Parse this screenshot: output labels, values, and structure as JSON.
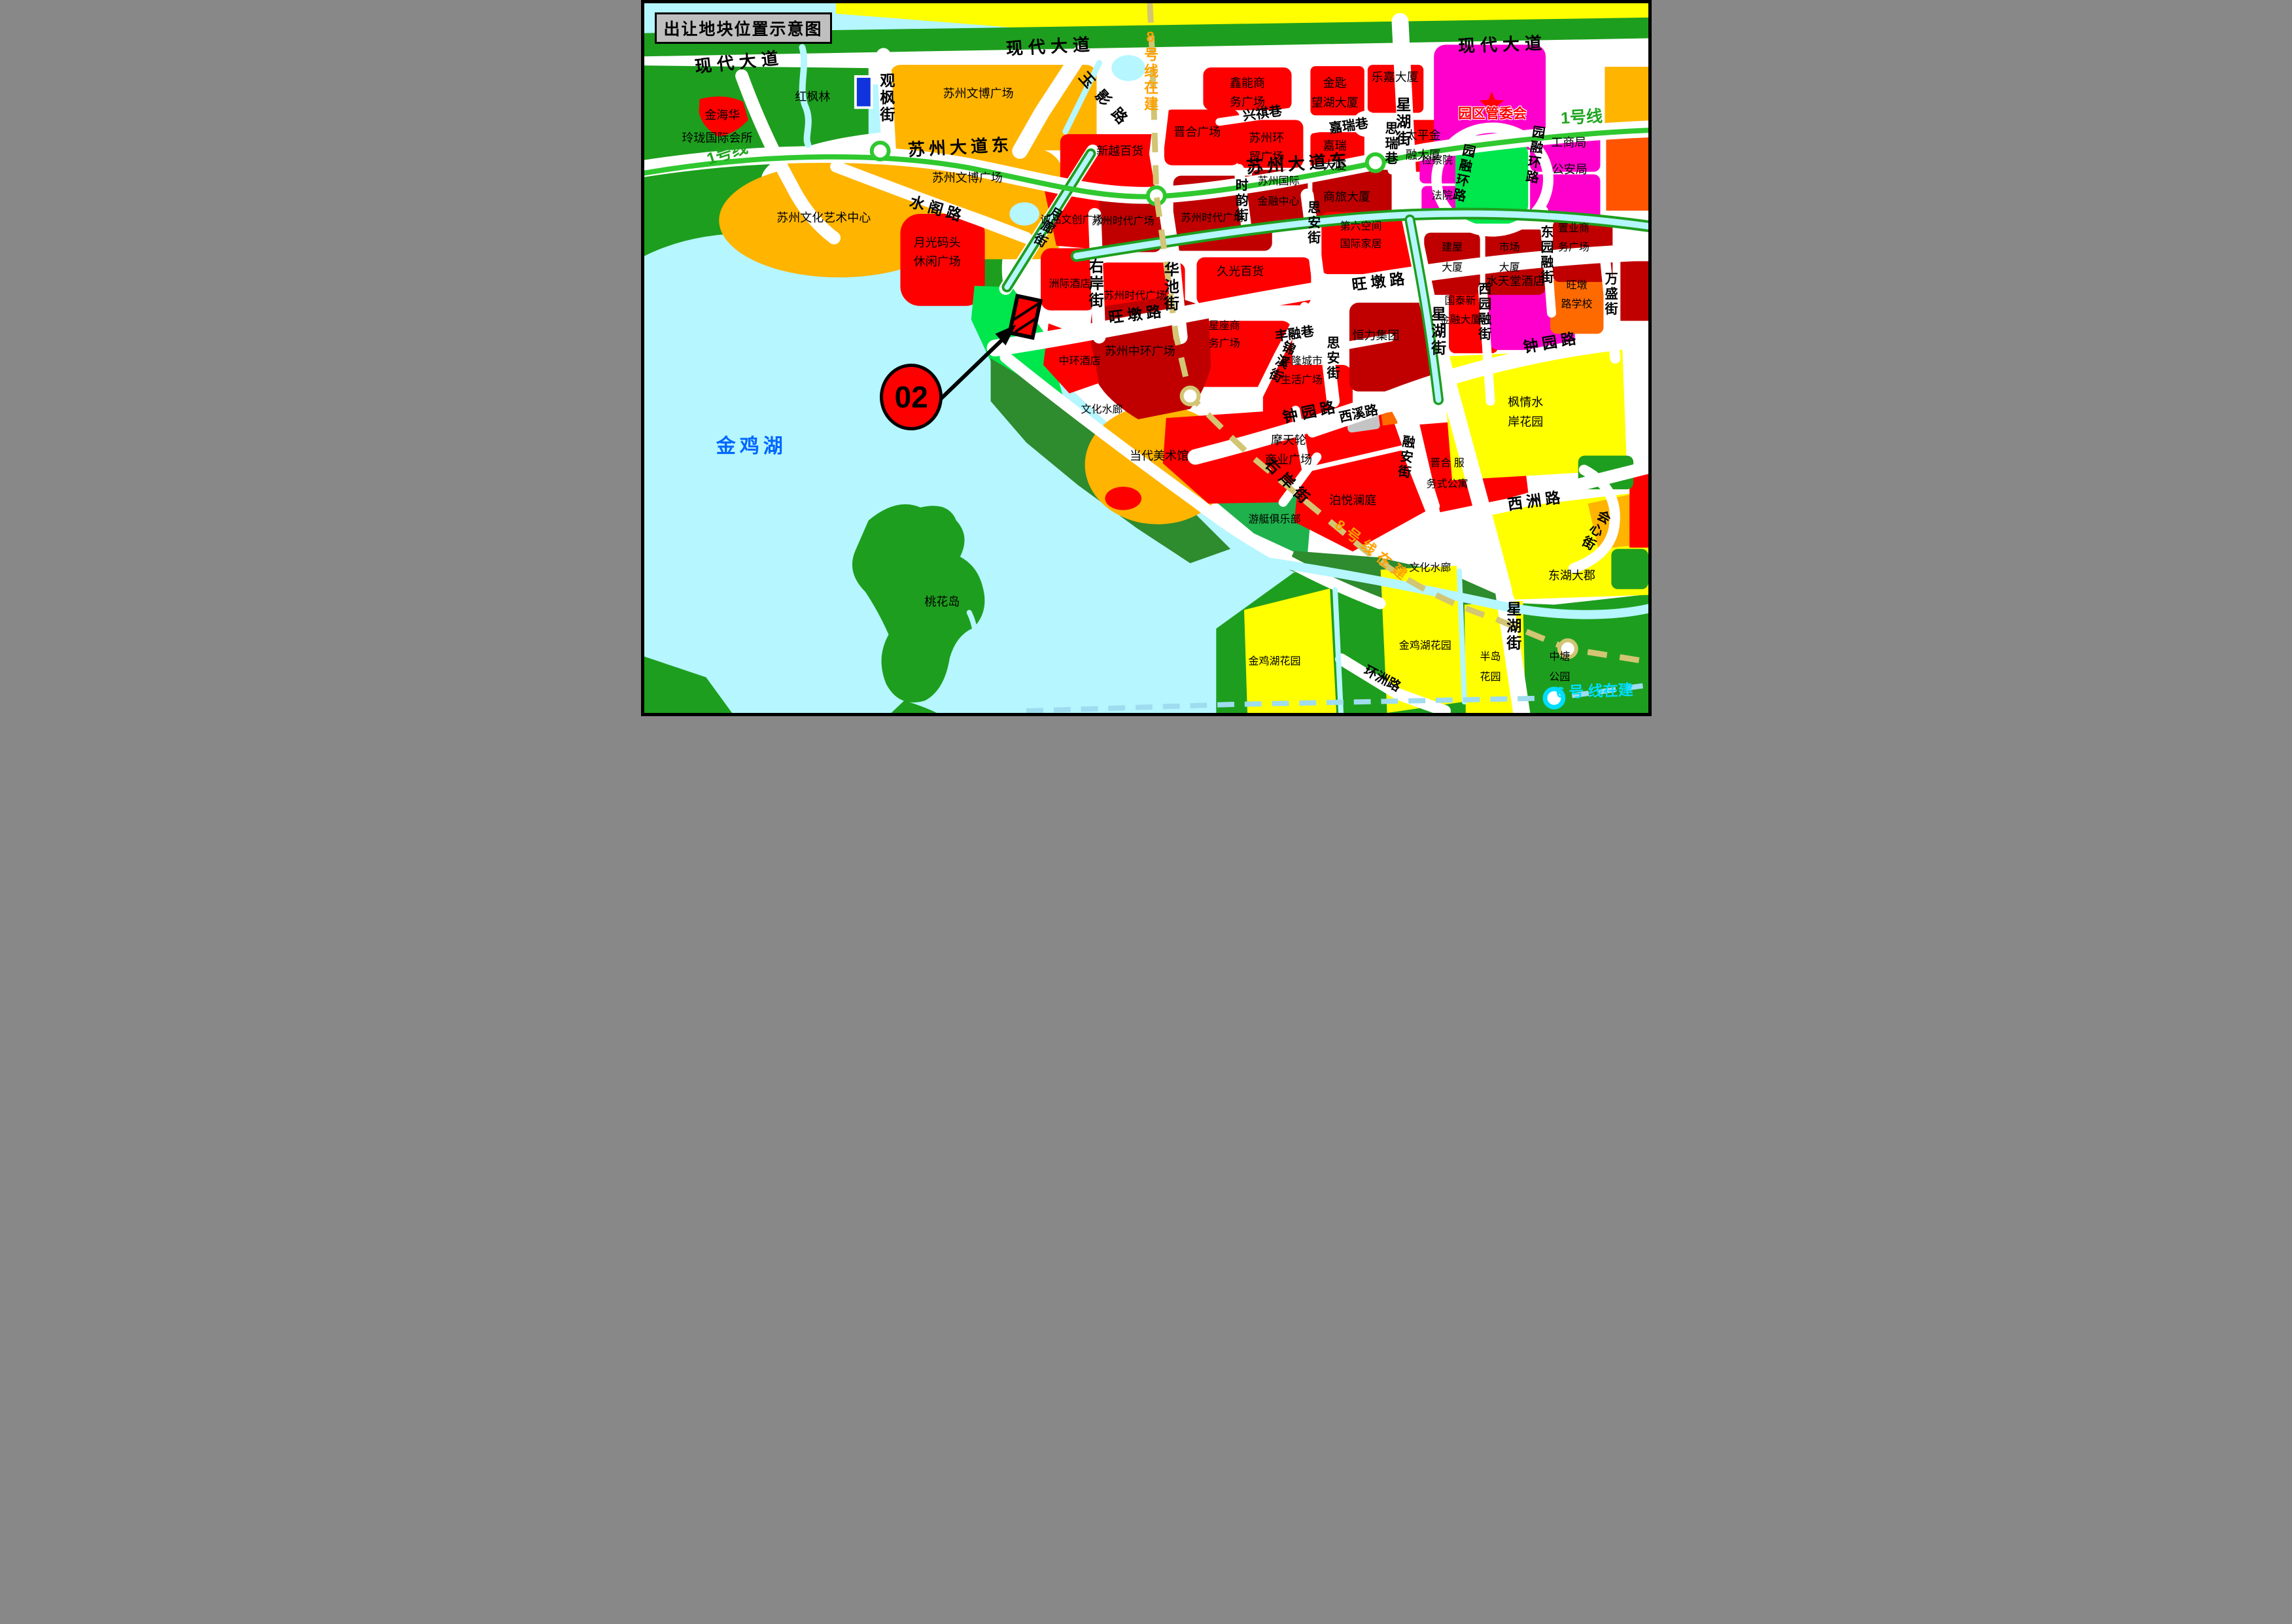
{
  "title": "出让地块位置示意图",
  "marker": {
    "label": "02"
  },
  "palette": {
    "water": "#B5F6FF",
    "green": "#1E9E1E",
    "dkgreen": "#2E8B2E",
    "brgreen": "#00E64D",
    "mdgreen": "#1FB14C",
    "yellow": "#FFFF00",
    "orange": "#FFB400",
    "dporange": "#FF6A00",
    "orangered": "#FF5500",
    "red": "#FF0000",
    "dkred": "#C00000",
    "magenta": "#FF00CC",
    "gray": "#C4C4C4",
    "blue": "#1133DD",
    "road": "#FFFFFF",
    "metro1": "#2FC82F",
    "metro1text": "#1FA51F",
    "metro8": "#D2C573",
    "metro8text": "#FFA000",
    "metro6": "#9FDCEF",
    "metro6text": "#00DDFF",
    "laketext": "#0066FF"
  },
  "labels": [
    {
      "name": "road-xiandai-dadao-west",
      "text": "现代大道",
      "x": 9.5,
      "y": 8.3,
      "rot": -6,
      "cls": "xl",
      "ls": 8
    },
    {
      "name": "road-xiandai-dadao-center",
      "text": "现代大道",
      "x": 40.5,
      "y": 6.1,
      "rot": -3,
      "cls": "xl",
      "ls": 8
    },
    {
      "name": "road-xiandai-dadao-east",
      "text": "现代大道",
      "x": 85.5,
      "y": 5.8,
      "rot": -2,
      "cls": "xl",
      "ls": 8
    },
    {
      "name": "road-suzhou-ave-east-w",
      "text": "苏州大道东",
      "x": 31.5,
      "y": 20.3,
      "rot": -3,
      "cls": "xl",
      "ls": 6
    },
    {
      "name": "road-suzhou-ave-east-e",
      "text": "苏州大道东",
      "x": 65.2,
      "y": 22.6,
      "rot": -4,
      "cls": "xl",
      "ls": 6
    },
    {
      "name": "road-guanfeng-st",
      "text": "观枫街",
      "x": 24.1,
      "y": 13.4,
      "rot": 0,
      "cls": "lg v"
    },
    {
      "name": "road-yuying-rd",
      "text": "玉影路",
      "x": 46.0,
      "y": 13.8,
      "rot": 48,
      "cls": "lg",
      "ls": 14
    },
    {
      "name": "road-shuige-rd",
      "text": "水阁路",
      "x": 29.2,
      "y": 29.0,
      "rot": 16,
      "cls": "lg",
      "ls": 6
    },
    {
      "name": "road-yuelang-st",
      "text": "月廊街",
      "x": 40.1,
      "y": 31.5,
      "rot": 30,
      "cls": "md v"
    },
    {
      "name": "road-youan-st-n",
      "text": "右岸街",
      "x": 44.9,
      "y": 39.5,
      "rot": 0,
      "cls": "lg v"
    },
    {
      "name": "road-youan-st-s",
      "text": "右岸街",
      "x": 64.2,
      "y": 67.6,
      "rot": 45,
      "cls": "lg",
      "ls": 8
    },
    {
      "name": "road-huachi-st",
      "text": "华池街",
      "x": 52.4,
      "y": 40.0,
      "rot": 0,
      "cls": "lg v"
    },
    {
      "name": "road-shiyun-st",
      "text": "时韵街",
      "x": 59.4,
      "y": 27.8,
      "rot": 0,
      "cls": "md v"
    },
    {
      "name": "road-sian-st-n",
      "text": "思安街",
      "x": 66.6,
      "y": 31.0,
      "rot": 0,
      "cls": "md v"
    },
    {
      "name": "road-sian-st-s",
      "text": "思安街",
      "x": 68.5,
      "y": 50.0,
      "rot": 0,
      "cls": "md v"
    },
    {
      "name": "road-xingqi-lane",
      "text": "兴祺巷",
      "x": 61.6,
      "y": 15.6,
      "rot": -8,
      "cls": "md"
    },
    {
      "name": "road-jiarui-lane",
      "text": "嘉瑞巷",
      "x": 70.2,
      "y": 17.3,
      "rot": -8,
      "cls": "md"
    },
    {
      "name": "road-sirui-lane",
      "text": "思瑞巷",
      "x": 74.3,
      "y": 19.8,
      "rot": 0,
      "cls": "md v"
    },
    {
      "name": "road-xinghu-st-top",
      "text": "星湖街",
      "x": 75.5,
      "y": 16.8,
      "rot": 0,
      "cls": "lg v"
    },
    {
      "name": "road-xinghu-st-mid",
      "text": "星湖街",
      "x": 79.0,
      "y": 46.3,
      "rot": 0,
      "cls": "lg v"
    },
    {
      "name": "road-xinghu-st-bot",
      "text": "星湖街",
      "x": 86.5,
      "y": 87.8,
      "rot": 0,
      "cls": "lg v"
    },
    {
      "name": "road-wangdun-rd-w",
      "text": "旺墩路",
      "x": 49.1,
      "y": 43.9,
      "rot": -7,
      "cls": "lg",
      "ls": 6
    },
    {
      "name": "road-wangdun-rd-e",
      "text": "旺墩路",
      "x": 73.3,
      "y": 39.3,
      "rot": -7,
      "cls": "lg",
      "ls": 6
    },
    {
      "name": "road-zhongyuan-rd-w",
      "text": "钟园路",
      "x": 66.4,
      "y": 57.6,
      "rot": -12,
      "cls": "lg",
      "ls": 6
    },
    {
      "name": "road-zhongyuan-rd-e",
      "text": "钟园路",
      "x": 90.4,
      "y": 47.8,
      "rot": -10,
      "cls": "lg",
      "ls": 6
    },
    {
      "name": "road-fengrong-lane",
      "text": "丰融巷",
      "x": 64.8,
      "y": 46.6,
      "rot": -8,
      "cls": "md"
    },
    {
      "name": "road-jinxi-st",
      "text": "锦溪街",
      "x": 63.4,
      "y": 50.5,
      "rot": 25,
      "cls": "md v"
    },
    {
      "name": "road-xixi-rd",
      "text": "西溪路",
      "x": 71.2,
      "y": 57.9,
      "rot": -12,
      "cls": "md"
    },
    {
      "name": "road-rongan-st",
      "text": "融安街",
      "x": 75.8,
      "y": 64.0,
      "rot": 8,
      "cls": "md v"
    },
    {
      "name": "road-xizhou-rd",
      "text": "西洲路",
      "x": 88.8,
      "y": 70.1,
      "rot": -8,
      "cls": "lg",
      "ls": 6
    },
    {
      "name": "road-huixin-st",
      "text": "会心街",
      "x": 94.7,
      "y": 74.2,
      "rot": 30,
      "cls": "md v"
    },
    {
      "name": "road-wansheng-st",
      "text": "万盛街",
      "x": 96.2,
      "y": 41.0,
      "rot": 0,
      "cls": "md v"
    },
    {
      "name": "road-dongyuanrong-st",
      "text": "东园融街",
      "x": 89.8,
      "y": 35.5,
      "rot": 0,
      "cls": "md v"
    },
    {
      "name": "road-xiyuanrong-st",
      "text": "西园融街",
      "x": 83.6,
      "y": 43.5,
      "rot": 0,
      "cls": "md v"
    },
    {
      "name": "road-yuanrong-ring-w",
      "text": "园融环路",
      "x": 81.5,
      "y": 24.0,
      "rot": 12,
      "cls": "md v"
    },
    {
      "name": "road-yuanrong-ring-e",
      "text": "园融环路",
      "x": 88.6,
      "y": 21.4,
      "rot": 8,
      "cls": "md v"
    },
    {
      "name": "road-huanzhou-rd",
      "text": "环洲路",
      "x": 73.5,
      "y": 95.2,
      "rot": 28,
      "cls": "md"
    },
    {
      "name": "metro-line1-west",
      "text": "1号线",
      "x": 8.3,
      "y": 21.2,
      "rot": -18,
      "cls": "metro1"
    },
    {
      "name": "metro-line1-east",
      "text": "1号线",
      "x": 93.4,
      "y": 16.1,
      "rot": -3,
      "cls": "metro1"
    },
    {
      "name": "metro-line8-top",
      "text": "8号线在建",
      "x": 50.4,
      "y": 9.5,
      "rot": 0,
      "cls": "metro8 v"
    },
    {
      "name": "metro-line8-diag",
      "text": "8号线在建",
      "x": 72.6,
      "y": 77.2,
      "rot": 38,
      "cls": "metro8",
      "ls": 8
    },
    {
      "name": "metro-line6",
      "text": "6 号 线在建",
      "x": 94.7,
      "y": 97.0,
      "rot": -2,
      "cls": "metro6"
    },
    {
      "name": "area-hongfenglin",
      "text": "红枫林",
      "x": 16.8,
      "y": 13.2,
      "rot": 0,
      "cls": "bk"
    },
    {
      "name": "area-jinhaihua",
      "text": "金海华",
      "x": 7.8,
      "y": 15.8,
      "rot": 0,
      "cls": "bk"
    },
    {
      "name": "area-linglong-club",
      "text": "玲珑国际会所",
      "x": 7.3,
      "y": 19.0,
      "rot": 0,
      "cls": "bk"
    },
    {
      "name": "area-wenbo-plaza-n",
      "text": "苏州文博广场",
      "x": 33.3,
      "y": 12.7,
      "rot": 0,
      "cls": "bk"
    },
    {
      "name": "area-wenbo-plaza-s",
      "text": "苏州文博广场",
      "x": 32.2,
      "y": 24.6,
      "rot": 0,
      "cls": "bk"
    },
    {
      "name": "area-culture-art-center",
      "text": "苏州文化艺术中心",
      "x": 17.9,
      "y": 30.2,
      "rot": 0,
      "cls": "bk"
    },
    {
      "name": "area-moonlight-wharf-1",
      "text": "月光码头",
      "x": 29.2,
      "y": 33.7,
      "rot": 0,
      "cls": "bk"
    },
    {
      "name": "area-moonlight-wharf-2",
      "text": "休闲广场",
      "x": 29.2,
      "y": 36.4,
      "rot": 0,
      "cls": "bk"
    },
    {
      "name": "area-eslite-plaza",
      "text": "诚品文创广场",
      "x": 42.6,
      "y": 30.6,
      "rot": 0,
      "cls": "bksm"
    },
    {
      "name": "area-intercontinental-hotel",
      "text": "洲际酒店",
      "x": 42.4,
      "y": 39.6,
      "rot": 0,
      "cls": "bksm"
    },
    {
      "name": "area-xinyue-dept",
      "text": "新越百货",
      "x": 47.4,
      "y": 20.8,
      "rot": 0,
      "cls": "bk"
    },
    {
      "name": "area-jinhe-plaza",
      "text": "晋合广场",
      "x": 55.1,
      "y": 18.2,
      "rot": 0,
      "cls": "bk"
    },
    {
      "name": "area-xinneng-1",
      "text": "鑫能商",
      "x": 60.1,
      "y": 11.2,
      "rot": 0,
      "cls": "bk"
    },
    {
      "name": "area-xinneng-2",
      "text": "务广场",
      "x": 60.1,
      "y": 13.9,
      "rot": 0,
      "cls": "bk"
    },
    {
      "name": "area-huanmao-1",
      "text": "苏州环",
      "x": 62.0,
      "y": 19.0,
      "rot": 0,
      "cls": "bk"
    },
    {
      "name": "area-huanmao-2",
      "text": "贸广场",
      "x": 62.0,
      "y": 21.7,
      "rot": 0,
      "cls": "bk"
    },
    {
      "name": "area-jinshi-1",
      "text": "金匙",
      "x": 68.8,
      "y": 11.2,
      "rot": 0,
      "cls": "bk"
    },
    {
      "name": "area-jinshi-2",
      "text": "望湖大厦",
      "x": 68.8,
      "y": 14.0,
      "rot": 0,
      "cls": "bk"
    },
    {
      "name": "area-lejia-tower",
      "text": "乐嘉大厦",
      "x": 74.8,
      "y": 10.4,
      "rot": 0,
      "cls": "bk"
    },
    {
      "name": "area-jiarui-tower-1",
      "text": "嘉瑞",
      "x": 68.8,
      "y": 20.1,
      "rot": 0,
      "cls": "bk"
    },
    {
      "name": "area-jiarui-tower-2",
      "text": "大厦",
      "x": 68.8,
      "y": 22.9,
      "rot": 0,
      "cls": "bk"
    },
    {
      "name": "area-taiping-1",
      "text": "太平金",
      "x": 77.6,
      "y": 18.6,
      "rot": 0,
      "cls": "bk"
    },
    {
      "name": "area-taiping-2",
      "text": "融大厦",
      "x": 77.6,
      "y": 21.4,
      "rot": 0,
      "cls": "bk"
    },
    {
      "name": "area-sifc-1",
      "text": "苏州国际",
      "x": 63.2,
      "y": 25.2,
      "rot": 0,
      "cls": "bksm"
    },
    {
      "name": "area-sifc-2",
      "text": "金融中心",
      "x": 63.2,
      "y": 28.0,
      "rot": 0,
      "cls": "bksm"
    },
    {
      "name": "area-shanglv-tower",
      "text": "商旅大厦",
      "x": 70.0,
      "y": 27.3,
      "rot": 0,
      "cls": "bk"
    },
    {
      "name": "area-times-square-w",
      "text": "苏州时代广场",
      "x": 47.7,
      "y": 30.8,
      "rot": 0,
      "cls": "bksm"
    },
    {
      "name": "area-times-square-e",
      "text": "苏州时代广场",
      "x": 56.6,
      "y": 30.3,
      "rot": 0,
      "cls": "bksm"
    },
    {
      "name": "area-times-square-s",
      "text": "苏州时代广场",
      "x": 48.9,
      "y": 41.3,
      "rot": 0,
      "cls": "bksm"
    },
    {
      "name": "area-jiuguang-dept",
      "text": "久光百货",
      "x": 59.4,
      "y": 37.8,
      "rot": 0,
      "cls": "bk"
    },
    {
      "name": "area-sixth-space-1",
      "text": "第六空间",
      "x": 71.4,
      "y": 31.5,
      "rot": 0,
      "cls": "bksm"
    },
    {
      "name": "area-sixth-space-2",
      "text": "国际家居",
      "x": 71.4,
      "y": 34.0,
      "rot": 0,
      "cls": "bksm"
    },
    {
      "name": "area-zhonghuan-plaza",
      "text": "苏州中环广场",
      "x": 49.4,
      "y": 49.0,
      "rot": 0,
      "cls": "bk"
    },
    {
      "name": "area-zhonghuan-hotel",
      "text": "中环酒店",
      "x": 43.4,
      "y": 50.5,
      "rot": 0,
      "cls": "bksm"
    },
    {
      "name": "area-culture-corridor-1",
      "text": "文化水廊",
      "x": 45.6,
      "y": 57.3,
      "rot": 0,
      "cls": "bksm"
    },
    {
      "name": "area-xingzuo-1",
      "text": "星座商",
      "x": 57.8,
      "y": 45.5,
      "rot": 0,
      "cls": "bksm"
    },
    {
      "name": "area-xingzuo-2",
      "text": "务广场",
      "x": 57.8,
      "y": 48.0,
      "rot": 0,
      "cls": "bksm"
    },
    {
      "name": "area-fenglong-1",
      "text": "丰隆城市",
      "x": 65.5,
      "y": 50.5,
      "rot": 0,
      "cls": "bksm"
    },
    {
      "name": "area-fenglong-2",
      "text": "生活广场",
      "x": 65.5,
      "y": 53.2,
      "rot": 0,
      "cls": "bksm"
    },
    {
      "name": "area-hengli-group",
      "text": "恒力集团",
      "x": 72.9,
      "y": 46.8,
      "rot": 0,
      "cls": "bk"
    },
    {
      "name": "area-guotai-1",
      "text": "国泰新",
      "x": 81.3,
      "y": 42.0,
      "rot": 0,
      "cls": "bksm"
    },
    {
      "name": "area-guotai-2",
      "text": "金融大厦",
      "x": 81.3,
      "y": 44.7,
      "rot": 0,
      "cls": "bksm"
    },
    {
      "name": "area-shuitiantang-hotel",
      "text": "水天堂酒店",
      "x": 86.8,
      "y": 39.2,
      "rot": 0,
      "cls": "bk"
    },
    {
      "name": "area-wangdun-school-1",
      "text": "旺墩",
      "x": 92.9,
      "y": 39.8,
      "rot": 0,
      "cls": "bksm"
    },
    {
      "name": "area-wangdun-school-2",
      "text": "路学校",
      "x": 92.9,
      "y": 42.5,
      "rot": 0,
      "cls": "bksm"
    },
    {
      "name": "area-zhiye-1",
      "text": "置业商",
      "x": 92.6,
      "y": 31.8,
      "rot": 0,
      "cls": "bksm"
    },
    {
      "name": "area-zhiye-2",
      "text": "务广场",
      "x": 92.6,
      "y": 34.5,
      "rot": 0,
      "cls": "bksm"
    },
    {
      "name": "area-shichang-1",
      "text": "市场",
      "x": 86.2,
      "y": 34.5,
      "rot": 0,
      "cls": "bksm"
    },
    {
      "name": "area-shichang-2",
      "text": "大厦",
      "x": 86.2,
      "y": 37.3,
      "rot": 0,
      "cls": "bksm"
    },
    {
      "name": "area-jianwu-1",
      "text": "建屋",
      "x": 80.5,
      "y": 34.5,
      "rot": 0,
      "cls": "bksm"
    },
    {
      "name": "area-jianwu-2",
      "text": "大厦",
      "x": 80.5,
      "y": 37.3,
      "rot": 0,
      "cls": "bksm"
    },
    {
      "name": "area-procuratorate",
      "text": "检察院",
      "x": 79.0,
      "y": 22.2,
      "rot": 0,
      "cls": "bksm"
    },
    {
      "name": "area-court",
      "text": "法院",
      "x": 79.5,
      "y": 27.2,
      "rot": 0,
      "cls": "bksm"
    },
    {
      "name": "area-industry-commerce-bureau",
      "text": "工商局",
      "x": 92.1,
      "y": 19.6,
      "rot": 0,
      "cls": "bk"
    },
    {
      "name": "area-public-security-bureau",
      "text": "公安局",
      "x": 92.2,
      "y": 23.4,
      "rot": 0,
      "cls": "bk"
    },
    {
      "name": "area-sip-admin-committee",
      "text": "园区管委会",
      "x": 84.5,
      "y": 15.6,
      "rot": 0,
      "cls": "govt"
    },
    {
      "name": "area-fengqing-1",
      "text": "枫情水",
      "x": 87.8,
      "y": 56.2,
      "rot": 0,
      "cls": "bk"
    },
    {
      "name": "area-fengqing-2",
      "text": "岸花园",
      "x": 87.8,
      "y": 59.0,
      "rot": 0,
      "cls": "bk"
    },
    {
      "name": "area-donghu-dajun",
      "text": "东湖大郡",
      "x": 92.4,
      "y": 80.6,
      "rot": 0,
      "cls": "bk"
    },
    {
      "name": "area-ferris-wheel-1",
      "text": "摩天轮",
      "x": 64.2,
      "y": 61.6,
      "rot": 0,
      "cls": "bk"
    },
    {
      "name": "area-ferris-wheel-2",
      "text": "商业广场",
      "x": 64.2,
      "y": 64.3,
      "rot": 0,
      "cls": "bk"
    },
    {
      "name": "area-boyue-lanting",
      "text": "泊悦澜庭",
      "x": 70.6,
      "y": 70.0,
      "rot": 0,
      "cls": "bk"
    },
    {
      "name": "area-jinhe-apartment-1",
      "text": "晋合 服",
      "x": 80.0,
      "y": 64.9,
      "rot": 0,
      "cls": "bksm"
    },
    {
      "name": "area-jinhe-apartment-2",
      "text": "务式公寓",
      "x": 80.0,
      "y": 67.8,
      "rot": 0,
      "cls": "bksm"
    },
    {
      "name": "area-yacht-club",
      "text": "游艇俱乐部",
      "x": 62.8,
      "y": 72.8,
      "rot": 0,
      "cls": "bksm"
    },
    {
      "name": "area-contemporary-art-museum",
      "text": "当代美术馆",
      "x": 51.3,
      "y": 63.8,
      "rot": 0,
      "cls": "bk"
    },
    {
      "name": "area-culture-corridor-2",
      "text": "文化水廊",
      "x": 78.3,
      "y": 79.6,
      "rot": 0,
      "cls": "bksm"
    },
    {
      "name": "area-taohua-island",
      "text": "桃花岛",
      "x": 29.7,
      "y": 84.3,
      "rot": 0,
      "cls": "bk"
    },
    {
      "name": "area-jinjihu-garden-l",
      "text": "金鸡湖花园",
      "x": 62.8,
      "y": 92.8,
      "rot": 0,
      "cls": "bksm"
    },
    {
      "name": "area-jinjihu-garden-r",
      "text": "金鸡湖花园",
      "x": 77.8,
      "y": 90.6,
      "rot": 0,
      "cls": "bksm"
    },
    {
      "name": "area-bandao-1",
      "text": "半岛",
      "x": 84.3,
      "y": 92.2,
      "rot": 0,
      "cls": "bksm"
    },
    {
      "name": "area-bandao-2",
      "text": "花园",
      "x": 84.3,
      "y": 95.0,
      "rot": 0,
      "cls": "bksm"
    },
    {
      "name": "area-zhongtang-1",
      "text": "中塘",
      "x": 91.2,
      "y": 92.2,
      "rot": 0,
      "cls": "bksm"
    },
    {
      "name": "area-zhongtang-2",
      "text": "公园",
      "x": 91.2,
      "y": 95.0,
      "rot": 0,
      "cls": "bksm"
    },
    {
      "name": "lake-jinjihu",
      "text": "金鸡湖",
      "x": 10.7,
      "y": 62.5,
      "rot": 0,
      "cls": "lake"
    }
  ]
}
